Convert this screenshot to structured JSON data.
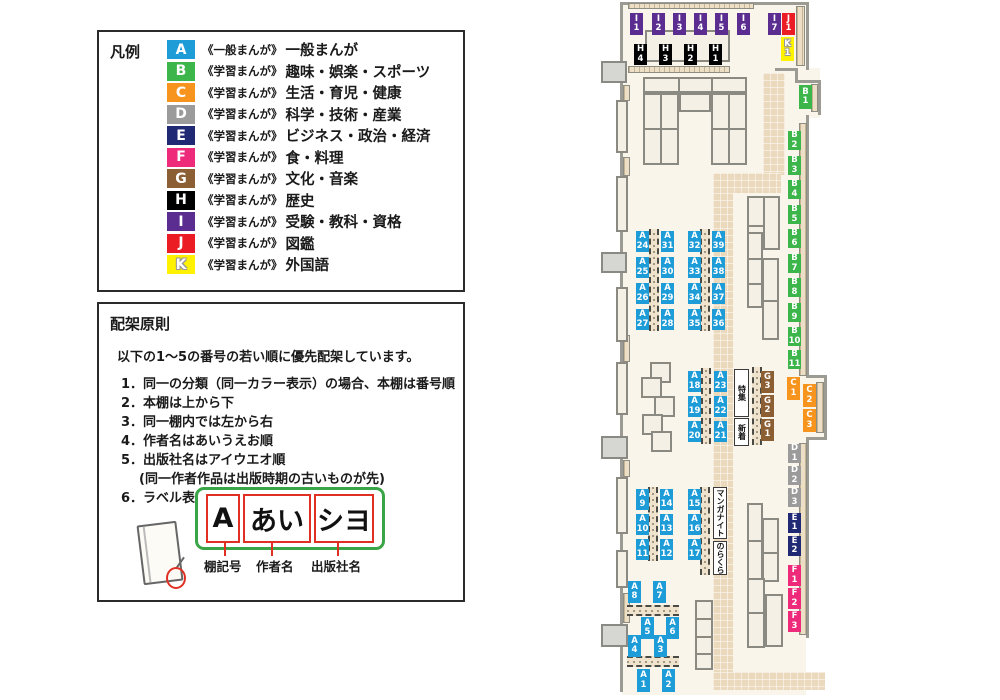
{
  "colors": {
    "A": "#1e9cd7",
    "B": "#3cb54a",
    "C": "#f7941d",
    "D": "#9b9b9b",
    "E": "#202a74",
    "F": "#ee2a7b",
    "G": "#8b5e34",
    "H": "#000000",
    "I": "#5c2d91",
    "J": "#ec1c24",
    "K": "#fff200"
  },
  "legend": {
    "title": "凡例",
    "items": [
      {
        "code": "A",
        "color": "#1e9cd7",
        "scope": "《一般まんが》",
        "label": "一般まんが"
      },
      {
        "code": "B",
        "color": "#3cb54a",
        "scope": "《学習まんが》",
        "label": "趣味・娯楽・スポーツ"
      },
      {
        "code": "C",
        "color": "#f7941d",
        "scope": "《学習まんが》",
        "label": "生活・育児・健康"
      },
      {
        "code": "D",
        "color": "#9b9b9b",
        "scope": "《学習まんが》",
        "label": "科学・技術・産業"
      },
      {
        "code": "E",
        "color": "#202a74",
        "scope": "《学習まんが》",
        "label": "ビジネス・政治・経済"
      },
      {
        "code": "F",
        "color": "#ee2a7b",
        "scope": "《学習まんが》",
        "label": "食・料理"
      },
      {
        "code": "G",
        "color": "#8b5e34",
        "scope": "《学習まんが》",
        "label": "文化・音楽"
      },
      {
        "code": "H",
        "color": "#000000",
        "scope": "《学習まんが》",
        "label": "歴史"
      },
      {
        "code": "I",
        "color": "#5c2d91",
        "scope": "《学習まんが》",
        "label": "受験・教科・資格"
      },
      {
        "code": "J",
        "color": "#ec1c24",
        "scope": "《学習まんが》",
        "label": "図鑑"
      },
      {
        "code": "K",
        "color": "#fff200",
        "scope": "《学習まんが》",
        "label": "外国語"
      }
    ]
  },
  "principles": {
    "title": "配架原則",
    "intro": "以下の1～5の番号の若い順に優先配架しています。",
    "rules": [
      "1．同一の分類（同一カラー表示）の場合、本棚は番号順",
      "2．本棚は上から下",
      "3．同一棚内では左から右",
      "4．作者名はあいうえお順",
      "5．出版社名はアイウエオ順",
      "6．ラベル表記は下図の通り"
    ],
    "note": "(同一作者作品は出版時期の古いものが先)",
    "example": {
      "box1": "A",
      "box2": "あい",
      "box3": "シヨ",
      "cap1": "棚記号",
      "cap2": "作者名",
      "cap3": "出版社名"
    }
  },
  "map": {
    "labels": [
      {
        "c": "I",
        "t": "I\n1",
        "x": 630,
        "y": 13,
        "w": 13,
        "h": 22
      },
      {
        "c": "I",
        "t": "I\n2",
        "x": 652,
        "y": 13,
        "w": 13,
        "h": 22
      },
      {
        "c": "I",
        "t": "I\n3",
        "x": 673,
        "y": 13,
        "w": 13,
        "h": 22
      },
      {
        "c": "I",
        "t": "I\n4",
        "x": 694,
        "y": 13,
        "w": 13,
        "h": 22
      },
      {
        "c": "I",
        "t": "I\n5",
        "x": 715,
        "y": 13,
        "w": 13,
        "h": 22
      },
      {
        "c": "I",
        "t": "I\n6",
        "x": 737,
        "y": 13,
        "w": 13,
        "h": 22
      },
      {
        "c": "I",
        "t": "I\n7",
        "x": 768,
        "y": 13,
        "w": 13,
        "h": 22
      },
      {
        "c": "J",
        "t": "J\n1",
        "x": 782,
        "y": 13,
        "w": 13,
        "h": 22
      },
      {
        "c": "K",
        "t": "K\n1",
        "x": 781,
        "y": 37,
        "w": 13,
        "h": 24
      },
      {
        "c": "H",
        "t": "H\n4",
        "x": 634,
        "y": 44,
        "w": 13,
        "h": 21
      },
      {
        "c": "H",
        "t": "H\n3",
        "x": 659,
        "y": 44,
        "w": 13,
        "h": 21
      },
      {
        "c": "H",
        "t": "H\n2",
        "x": 684,
        "y": 44,
        "w": 13,
        "h": 21
      },
      {
        "c": "H",
        "t": "H\n1",
        "x": 709,
        "y": 44,
        "w": 13,
        "h": 21
      },
      {
        "c": "B",
        "t": "B\n1",
        "x": 799,
        "y": 85,
        "w": 13,
        "h": 24
      },
      {
        "c": "B",
        "t": "B\n2",
        "x": 788,
        "y": 131,
        "w": 13,
        "h": 19
      },
      {
        "c": "B",
        "t": "B\n3",
        "x": 788,
        "y": 156,
        "w": 13,
        "h": 19
      },
      {
        "c": "B",
        "t": "B\n4",
        "x": 788,
        "y": 180,
        "w": 13,
        "h": 19
      },
      {
        "c": "B",
        "t": "B\n5",
        "x": 788,
        "y": 205,
        "w": 13,
        "h": 19
      },
      {
        "c": "B",
        "t": "B\n6",
        "x": 788,
        "y": 229,
        "w": 13,
        "h": 19
      },
      {
        "c": "B",
        "t": "B\n7",
        "x": 788,
        "y": 254,
        "w": 13,
        "h": 19
      },
      {
        "c": "B",
        "t": "B\n8",
        "x": 788,
        "y": 278,
        "w": 13,
        "h": 19
      },
      {
        "c": "B",
        "t": "B\n9",
        "x": 788,
        "y": 303,
        "w": 13,
        "h": 19
      },
      {
        "c": "B",
        "t": "B\n10",
        "x": 788,
        "y": 327,
        "w": 13,
        "h": 19
      },
      {
        "c": "B",
        "t": "B\n11",
        "x": 788,
        "y": 350,
        "w": 13,
        "h": 19
      },
      {
        "c": "A",
        "t": "A\n24",
        "x": 636,
        "y": 231,
        "w": 13,
        "h": 21
      },
      {
        "c": "A",
        "t": "A\n25",
        "x": 636,
        "y": 257,
        "w": 13,
        "h": 21
      },
      {
        "c": "A",
        "t": "A\n26",
        "x": 636,
        "y": 283,
        "w": 13,
        "h": 21
      },
      {
        "c": "A",
        "t": "A\n27",
        "x": 636,
        "y": 309,
        "w": 13,
        "h": 21
      },
      {
        "c": "A",
        "t": "A\n31",
        "x": 661,
        "y": 231,
        "w": 13,
        "h": 21
      },
      {
        "c": "A",
        "t": "A\n30",
        "x": 661,
        "y": 257,
        "w": 13,
        "h": 21
      },
      {
        "c": "A",
        "t": "A\n29",
        "x": 661,
        "y": 283,
        "w": 13,
        "h": 21
      },
      {
        "c": "A",
        "t": "A\n28",
        "x": 661,
        "y": 309,
        "w": 13,
        "h": 21
      },
      {
        "c": "A",
        "t": "A\n32",
        "x": 688,
        "y": 231,
        "w": 13,
        "h": 21
      },
      {
        "c": "A",
        "t": "A\n33",
        "x": 688,
        "y": 257,
        "w": 13,
        "h": 21
      },
      {
        "c": "A",
        "t": "A\n34",
        "x": 688,
        "y": 283,
        "w": 13,
        "h": 21
      },
      {
        "c": "A",
        "t": "A\n35",
        "x": 688,
        "y": 309,
        "w": 13,
        "h": 21
      },
      {
        "c": "A",
        "t": "A\n39",
        "x": 712,
        "y": 231,
        "w": 13,
        "h": 21
      },
      {
        "c": "A",
        "t": "A\n38",
        "x": 712,
        "y": 257,
        "w": 13,
        "h": 21
      },
      {
        "c": "A",
        "t": "A\n37",
        "x": 712,
        "y": 283,
        "w": 13,
        "h": 21
      },
      {
        "c": "A",
        "t": "A\n36",
        "x": 712,
        "y": 309,
        "w": 13,
        "h": 21
      },
      {
        "c": "A",
        "t": "A\n18",
        "x": 688,
        "y": 371,
        "w": 13,
        "h": 21
      },
      {
        "c": "A",
        "t": "A\n19",
        "x": 688,
        "y": 396,
        "w": 13,
        "h": 21
      },
      {
        "c": "A",
        "t": "A\n20",
        "x": 688,
        "y": 421,
        "w": 13,
        "h": 21
      },
      {
        "c": "A",
        "t": "A\n23",
        "x": 714,
        "y": 371,
        "w": 13,
        "h": 21
      },
      {
        "c": "A",
        "t": "A\n22",
        "x": 714,
        "y": 396,
        "w": 13,
        "h": 21
      },
      {
        "c": "A",
        "t": "A\n21",
        "x": 714,
        "y": 421,
        "w": 13,
        "h": 21
      },
      {
        "c": "G",
        "t": "G\n3",
        "x": 761,
        "y": 371,
        "w": 13,
        "h": 22
      },
      {
        "c": "G",
        "t": "G\n2",
        "x": 761,
        "y": 395,
        "w": 13,
        "h": 22
      },
      {
        "c": "G",
        "t": "G\n1",
        "x": 761,
        "y": 419,
        "w": 13,
        "h": 22
      },
      {
        "c": "C",
        "t": "C\n1",
        "x": 787,
        "y": 377,
        "w": 13,
        "h": 23
      },
      {
        "c": "C",
        "t": "C\n2",
        "x": 803,
        "y": 384,
        "w": 13,
        "h": 23
      },
      {
        "c": "C",
        "t": "C\n3",
        "x": 803,
        "y": 409,
        "w": 13,
        "h": 23
      },
      {
        "c": "D",
        "t": "D\n1",
        "x": 788,
        "y": 444,
        "w": 13,
        "h": 19
      },
      {
        "c": "D",
        "t": "D\n2",
        "x": 788,
        "y": 466,
        "w": 13,
        "h": 19
      },
      {
        "c": "D",
        "t": "D\n3",
        "x": 788,
        "y": 488,
        "w": 13,
        "h": 19
      },
      {
        "c": "A",
        "t": "A\n9",
        "x": 636,
        "y": 489,
        "w": 13,
        "h": 21
      },
      {
        "c": "A",
        "t": "A\n10",
        "x": 636,
        "y": 514,
        "w": 13,
        "h": 21
      },
      {
        "c": "A",
        "t": "A\n11",
        "x": 636,
        "y": 539,
        "w": 13,
        "h": 21
      },
      {
        "c": "A",
        "t": "A\n14",
        "x": 660,
        "y": 489,
        "w": 13,
        "h": 21
      },
      {
        "c": "A",
        "t": "A\n13",
        "x": 660,
        "y": 514,
        "w": 13,
        "h": 21
      },
      {
        "c": "A",
        "t": "A\n12",
        "x": 660,
        "y": 539,
        "w": 13,
        "h": 21
      },
      {
        "c": "A",
        "t": "A\n15",
        "x": 688,
        "y": 489,
        "w": 13,
        "h": 21
      },
      {
        "c": "A",
        "t": "A\n16",
        "x": 688,
        "y": 514,
        "w": 13,
        "h": 21
      },
      {
        "c": "A",
        "t": "A\n17",
        "x": 688,
        "y": 539,
        "w": 13,
        "h": 21
      },
      {
        "c": "E",
        "t": "E\n1",
        "x": 788,
        "y": 513,
        "w": 13,
        "h": 20
      },
      {
        "c": "E",
        "t": "E\n2",
        "x": 788,
        "y": 536,
        "w": 13,
        "h": 20
      },
      {
        "c": "F",
        "t": "F\n1",
        "x": 788,
        "y": 565,
        "w": 13,
        "h": 21
      },
      {
        "c": "F",
        "t": "F\n2",
        "x": 788,
        "y": 588,
        "w": 13,
        "h": 21
      },
      {
        "c": "F",
        "t": "F\n3",
        "x": 788,
        "y": 611,
        "w": 13,
        "h": 21
      },
      {
        "c": "A",
        "t": "A\n8",
        "x": 628,
        "y": 581,
        "w": 13,
        "h": 22
      },
      {
        "c": "A",
        "t": "A\n7",
        "x": 653,
        "y": 581,
        "w": 13,
        "h": 22
      },
      {
        "c": "A",
        "t": "A\n5",
        "x": 641,
        "y": 617,
        "w": 13,
        "h": 22
      },
      {
        "c": "A",
        "t": "A\n6",
        "x": 666,
        "y": 617,
        "w": 13,
        "h": 22
      },
      {
        "c": "A",
        "t": "A\n4",
        "x": 628,
        "y": 635,
        "w": 13,
        "h": 22
      },
      {
        "c": "A",
        "t": "A\n3",
        "x": 654,
        "y": 635,
        "w": 13,
        "h": 22
      },
      {
        "c": "A",
        "t": "A\n1",
        "x": 637,
        "y": 669,
        "w": 13,
        "h": 23
      },
      {
        "c": "A",
        "t": "A\n2",
        "x": 662,
        "y": 669,
        "w": 13,
        "h": 23
      }
    ],
    "vtexts": [
      {
        "t": "特集",
        "x": 734,
        "y": 369,
        "w": 15,
        "h": 48
      },
      {
        "t": "新着",
        "x": 734,
        "y": 418,
        "w": 15,
        "h": 28
      },
      {
        "t": "マンガナイト",
        "x": 713,
        "y": 487,
        "w": 14,
        "h": 52
      },
      {
        "t": "のらくら",
        "x": 713,
        "y": 541,
        "w": 14,
        "h": 34
      }
    ]
  }
}
